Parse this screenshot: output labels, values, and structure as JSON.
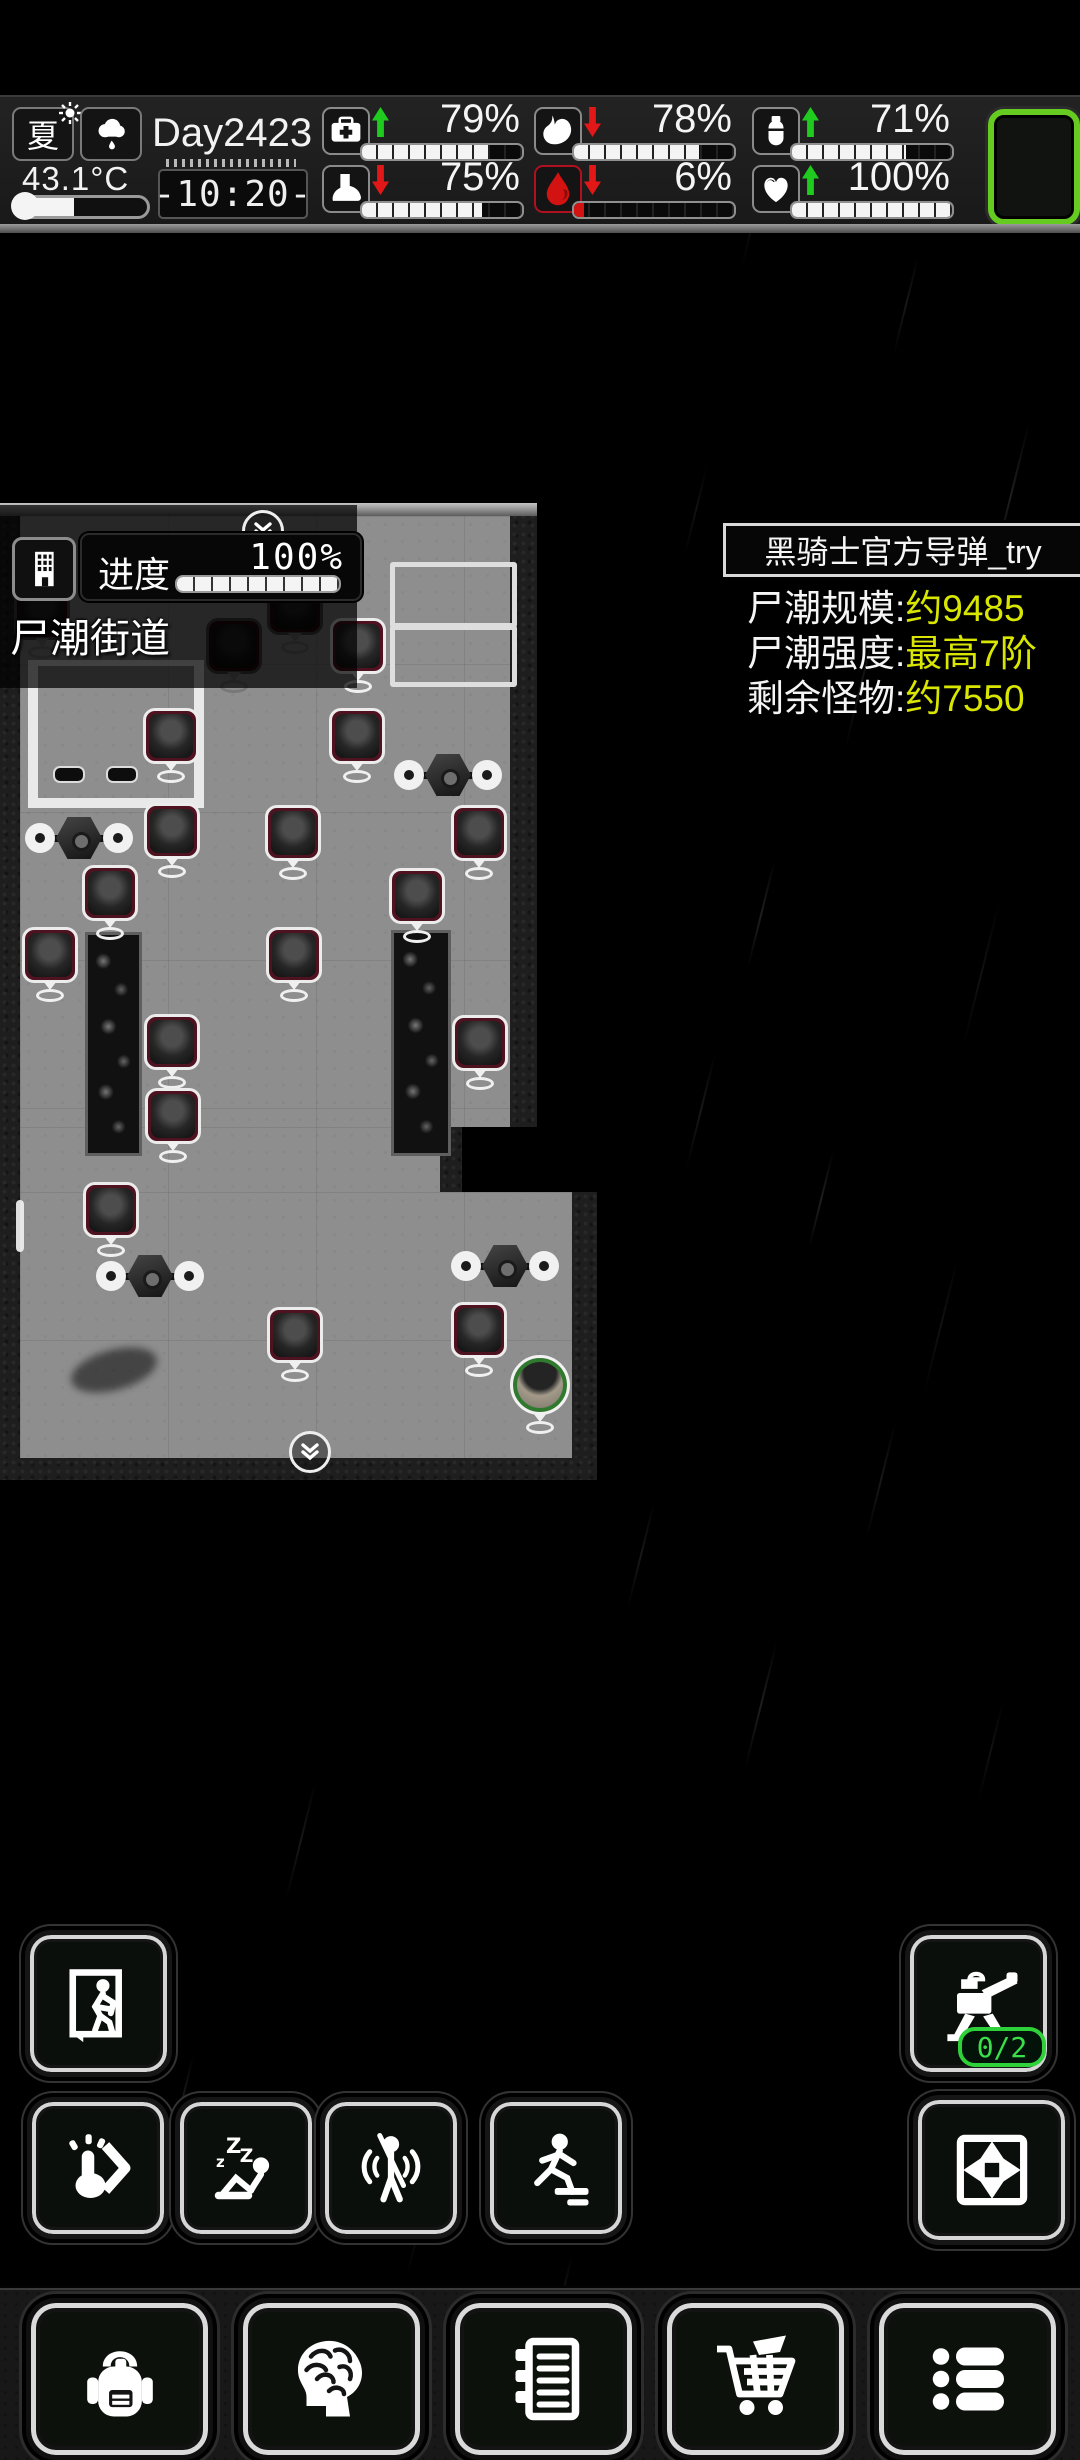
{
  "status_bar": {
    "season": "夏",
    "temperature": "43.1°C",
    "day": "Day2423",
    "time": "-10:20-",
    "stats": [
      {
        "icon": "medkit-icon",
        "trend": "up",
        "value": 79,
        "label": "79%"
      },
      {
        "icon": "stomach-icon",
        "trend": "down",
        "value": 78,
        "label": "78%"
      },
      {
        "icon": "water-icon",
        "trend": "up",
        "value": 71,
        "label": "71%"
      },
      {
        "icon": "foot-icon",
        "trend": "down",
        "value": 75,
        "label": "75%"
      },
      {
        "icon": "blood-icon",
        "trend": "down",
        "value": 6,
        "label": "6%",
        "fill_color": "#d31212",
        "box_border": "#b01020"
      },
      {
        "icon": "heart-icon",
        "trend": "up",
        "value": 100,
        "label": "100%"
      }
    ]
  },
  "map_panel": {
    "progress_label": "进度",
    "progress_value": "100%",
    "progress_percent": 100,
    "location_name": "尸潮街道"
  },
  "wave_info": {
    "title": "黑骑士官方导弹_try",
    "value_color": "#d8e600",
    "lines": [
      {
        "label": "尸潮规模:",
        "value": "约9485"
      },
      {
        "label": "尸潮强度:",
        "value": "最高7阶"
      },
      {
        "label": "剩余怪物:",
        "value": "约7550"
      }
    ]
  },
  "hud": {
    "turret_badge": "0/2"
  },
  "map": {
    "zombies": [
      {
        "x": 42,
        "y": 612,
        "dim": true
      },
      {
        "x": 295,
        "y": 607,
        "dim": true
      },
      {
        "x": 234,
        "y": 646,
        "dim": true
      },
      {
        "x": 358,
        "y": 646
      },
      {
        "x": 171,
        "y": 736
      },
      {
        "x": 357,
        "y": 736
      },
      {
        "x": 172,
        "y": 831
      },
      {
        "x": 293,
        "y": 833
      },
      {
        "x": 479,
        "y": 833
      },
      {
        "x": 110,
        "y": 893
      },
      {
        "x": 417,
        "y": 896
      },
      {
        "x": 50,
        "y": 955
      },
      {
        "x": 294,
        "y": 955
      },
      {
        "x": 172,
        "y": 1042
      },
      {
        "x": 480,
        "y": 1043
      },
      {
        "x": 173,
        "y": 1116
      },
      {
        "x": 111,
        "y": 1210
      },
      {
        "x": 295,
        "y": 1335
      },
      {
        "x": 479,
        "y": 1330
      }
    ],
    "gates": [
      {
        "x": 79,
        "y": 838
      },
      {
        "x": 448,
        "y": 775
      },
      {
        "x": 150,
        "y": 1276
      },
      {
        "x": 505,
        "y": 1266
      }
    ],
    "planters": [
      {
        "x": 85,
        "y": 932,
        "w": 51,
        "h": 218
      },
      {
        "x": 391,
        "y": 930,
        "w": 54,
        "h": 220
      }
    ],
    "outlined_rects": [
      {
        "x": 390,
        "y": 562,
        "w": 117,
        "h": 56
      },
      {
        "x": 390,
        "y": 625,
        "w": 117,
        "h": 52
      }
    ],
    "room": {
      "x": 28,
      "y": 660,
      "w": 156,
      "h": 132
    },
    "benches": [
      {
        "x": 53,
        "y": 766
      },
      {
        "x": 106,
        "y": 766
      }
    ],
    "player": {
      "x": 540,
      "y": 1385
    },
    "scroll_chevrons": [
      {
        "x": 263,
        "y": 531
      },
      {
        "x": 310,
        "y": 1452
      }
    ],
    "scrollbar": {
      "x": 16,
      "y": 1200,
      "w": 8,
      "h": 52
    },
    "shadow": {
      "x": 70,
      "y": 1350,
      "w": 88,
      "h": 40
    }
  }
}
